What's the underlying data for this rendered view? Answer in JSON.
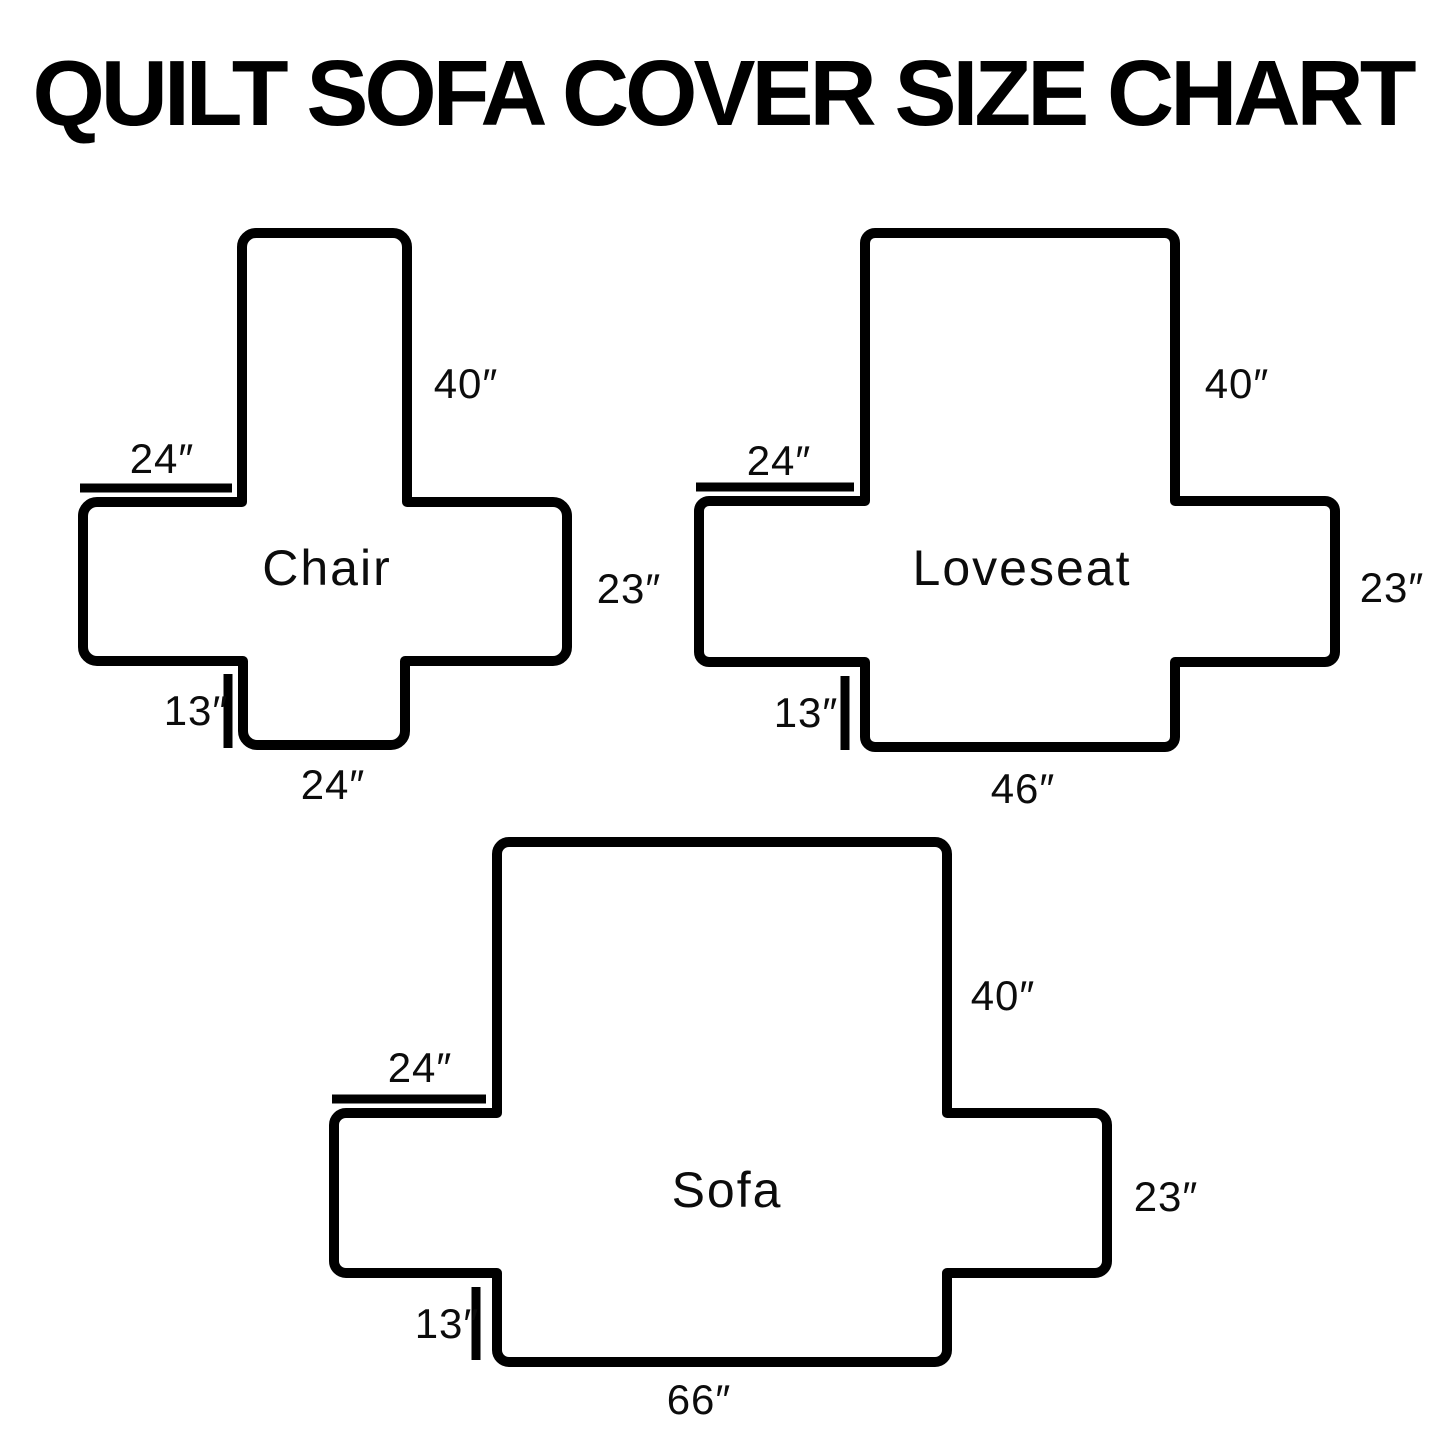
{
  "title": "QUILT SOFA COVER SIZE CHART",
  "covers": [
    {
      "name": "Chair",
      "dimensions": {
        "back_height": "40″",
        "arm_top_width": "24″",
        "arm_side_height": "23″",
        "front_skirt_drop": "13″",
        "seat_front_width": "24″"
      }
    },
    {
      "name": "Loveseat",
      "dimensions": {
        "back_height": "40″",
        "arm_top_width": "24″",
        "arm_side_height": "23″",
        "front_skirt_drop": "13″",
        "seat_front_width": "46″"
      }
    },
    {
      "name": "Sofa",
      "dimensions": {
        "back_height": "40″",
        "arm_top_width": "24″",
        "arm_side_height": "23″",
        "front_skirt_drop": "13″",
        "seat_front_width": "66″"
      }
    }
  ],
  "colors": {
    "line": "#000000",
    "background": "#ffffff"
  }
}
